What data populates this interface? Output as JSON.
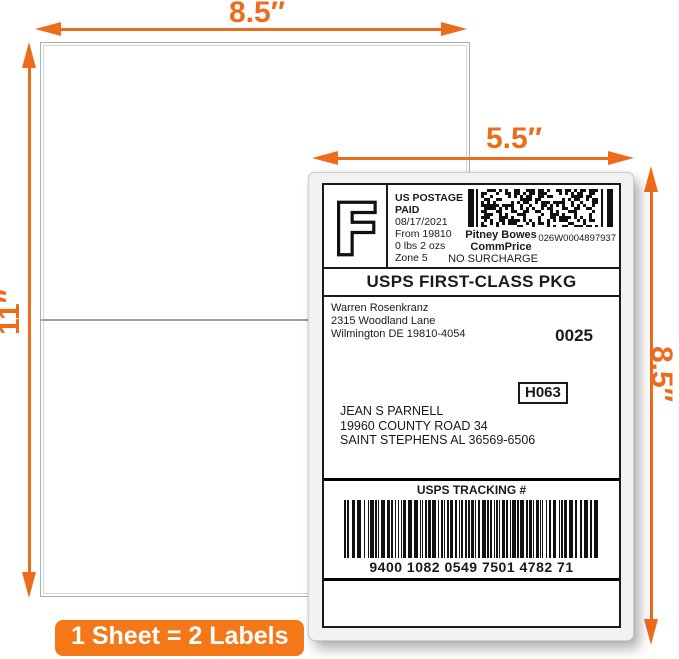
{
  "colors": {
    "arrow_orange": "#ED6C1C",
    "badge_orange": "#F47718",
    "label_text": "#1a1a1a"
  },
  "annotations": {
    "sheet_width": "8.5″",
    "sheet_height": "11″",
    "label_width": "5.5″",
    "label_height": "8.5″",
    "badge": "1 Sheet = 2 Labels"
  },
  "label": {
    "fim_letter": "F",
    "postage": {
      "line1": "US POSTAGE",
      "line2": "PAID",
      "date": "08/17/2021",
      "from": "From 19810",
      "weight": "0 lbs 2 ozs",
      "zone": "Zone 5"
    },
    "meter": {
      "vendor_line1": "Pitney Bowes",
      "vendor_line2": "CommPrice",
      "number": "026W0004897937",
      "surcharge": "NO SURCHARGE"
    },
    "service": "USPS FIRST-CLASS PKG",
    "sender": {
      "name": "Warren Rosenkranz",
      "street": "2315 Woodland Lane",
      "city": "Wilmington DE 19810-4054"
    },
    "batch": "0025",
    "route": "H063",
    "recipient": {
      "name": "JEAN S PARNELL",
      "street": "19960 COUNTY ROAD 34",
      "city": "SAINT STEPHENS AL 36569-6506"
    },
    "tracking": {
      "title": "USPS TRACKING #",
      "number": "9400 1082 0549 7501 4782 71"
    }
  }
}
